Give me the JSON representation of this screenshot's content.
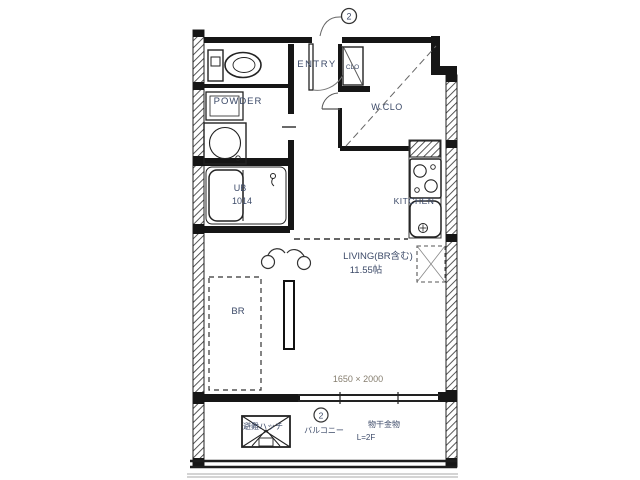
{
  "rooms": {
    "entry": "ENTRY",
    "entry_closet": "CLO",
    "powder": "POWDER",
    "walk_in_closet": "W.CLO",
    "kitchen": "KITCHEN",
    "living_label": "LIVING(BR含む)",
    "living_size": "11.55帖",
    "bedroom": "BR",
    "bath_label": "UB",
    "bath_size": "1014",
    "balcony": "バルコニー"
  },
  "annotations": {
    "window_size": "1650 × 2000",
    "escape_hatch": "避難ハッチ",
    "note_line1": "物干金物",
    "note_line2": "L=2F",
    "keynote_entry": "2",
    "keynote_balcony": "2"
  },
  "colors": {
    "ink": "#1f1f1f",
    "label_text": "#3c4a68",
    "dimension_text": "#867e6f",
    "paper": "#ffffff"
  }
}
